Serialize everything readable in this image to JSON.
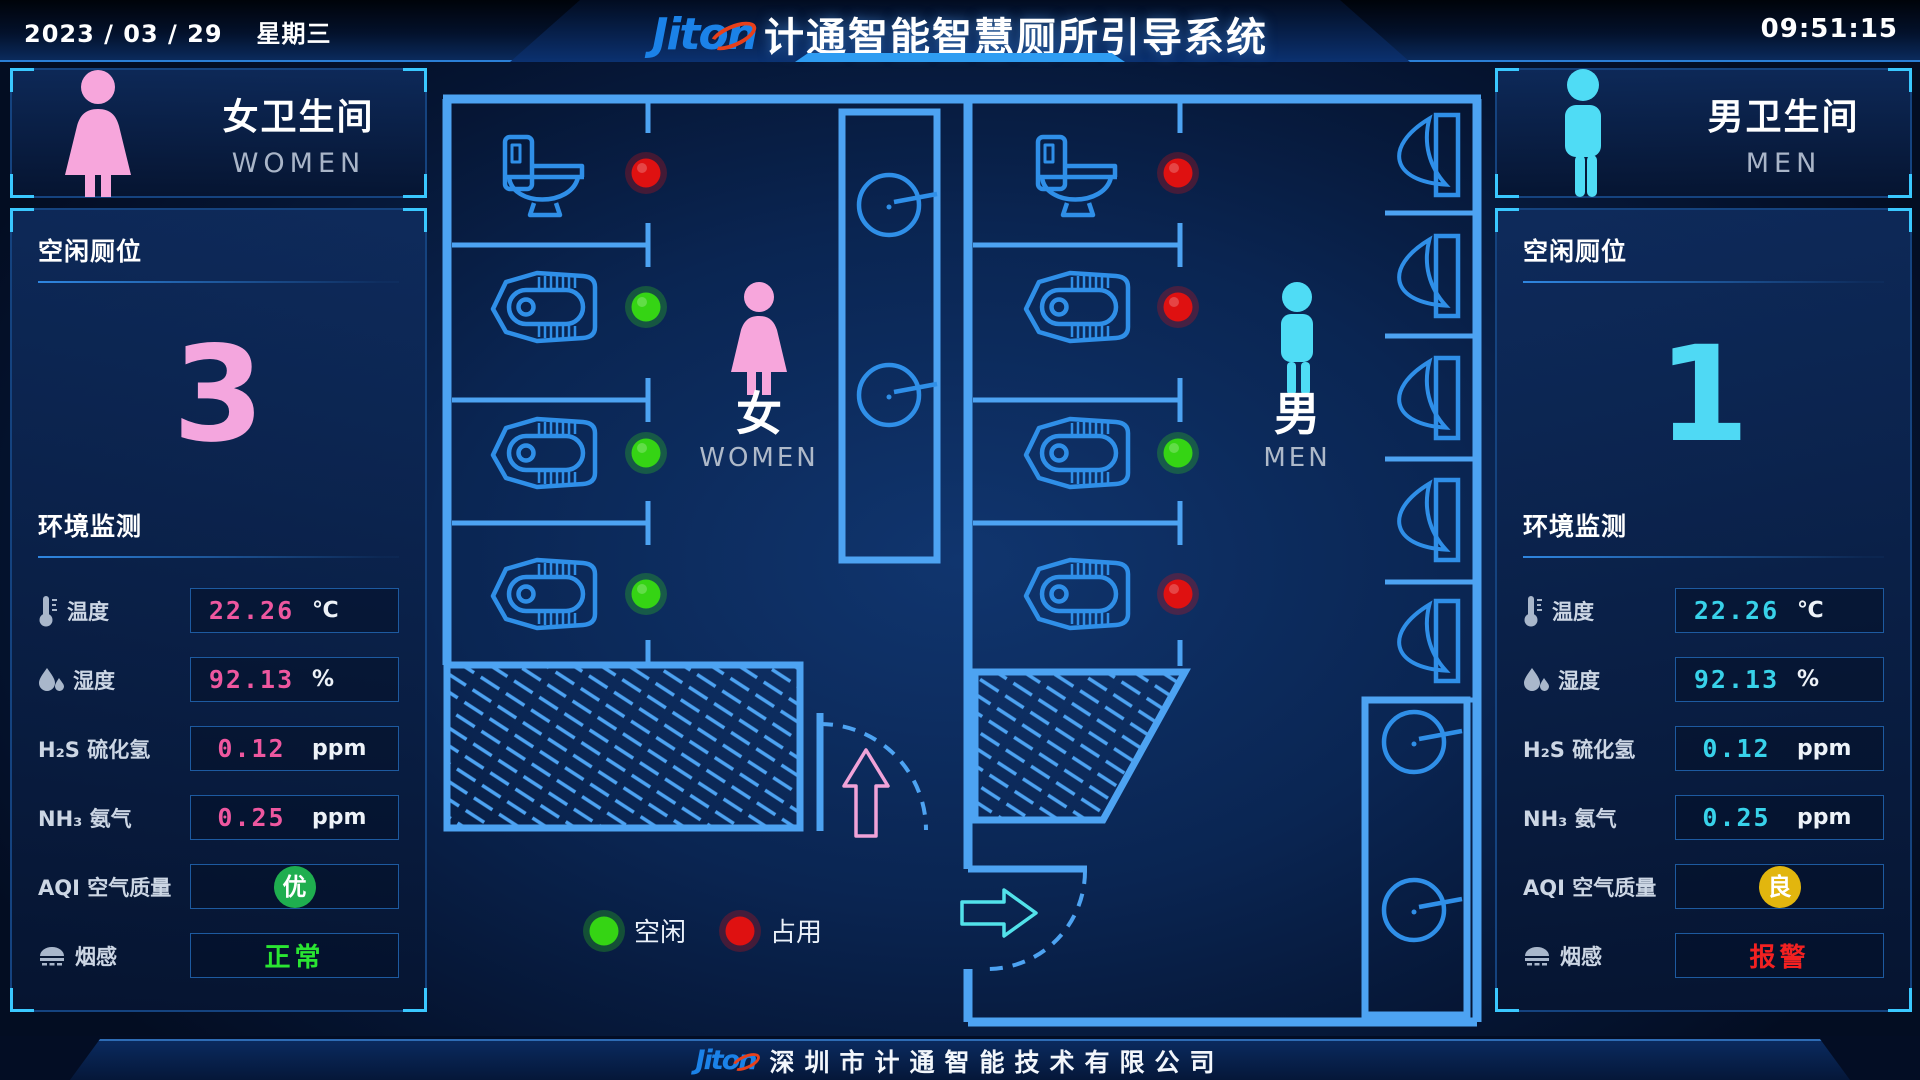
{
  "header": {
    "date": "2023 / 03 / 29",
    "weekday": "星期三",
    "logo": "Jiton",
    "title": "计通智能智慧厕所引导系统",
    "time": "09:51:15"
  },
  "footer": {
    "logo": "Jiton",
    "company": "深圳市计通智能技术有限公司"
  },
  "women_panel": {
    "name": "女卫生间",
    "name_en": "WOMEN",
    "accent": "#f4a6de",
    "vacant_label": "空闲厕位",
    "vacant_count": "3",
    "env_label": "环境监测",
    "metrics": {
      "temp": {
        "label": "温度",
        "value": "22.26",
        "unit": "℃"
      },
      "humidity": {
        "label": "湿度",
        "value": "92.13",
        "unit": "%"
      },
      "h2s": {
        "label": "H₂S 硫化氢",
        "value": "0.12",
        "unit": "ppm"
      },
      "nh3": {
        "label": "NH₃ 氨气",
        "value": "0.25",
        "unit": "ppm"
      },
      "aqi": {
        "label": "AQI 空气质量",
        "value": "优",
        "color": "#1fae4f"
      },
      "smoke": {
        "label": "烟感",
        "value": "正常",
        "color": "#2ae532"
      }
    }
  },
  "men_panel": {
    "name": "男卫生间",
    "name_en": "MEN",
    "accent": "#4fd9f4",
    "vacant_label": "空闲厕位",
    "vacant_count": "1",
    "env_label": "环境监测",
    "metrics": {
      "temp": {
        "label": "温度",
        "value": "22.26",
        "unit": "℃"
      },
      "humidity": {
        "label": "湿度",
        "value": "92.13",
        "unit": "%"
      },
      "h2s": {
        "label": "H₂S 硫化氢",
        "value": "0.12",
        "unit": "ppm"
      },
      "nh3": {
        "label": "NH₃ 氨气",
        "value": "0.25",
        "unit": "ppm"
      },
      "aqi": {
        "label": "AQI 空气质量",
        "value": "良",
        "color": "#e2b60e"
      },
      "smoke": {
        "label": "烟感",
        "value": "报警",
        "color": "#f32121"
      }
    }
  },
  "floorplan": {
    "women_label": "女",
    "women_label_en": "WOMEN",
    "men_label": "男",
    "men_label_en": "MEN",
    "legend": {
      "vacant": "空闲",
      "occupied": "占用"
    },
    "colors": {
      "vacant": "#35d414",
      "occupied": "#df1111"
    },
    "women_stalls": [
      "occupied",
      "vacant",
      "vacant",
      "vacant"
    ],
    "men_stalls": [
      "occupied",
      "occupied",
      "vacant",
      "occupied"
    ],
    "urinal_count": 5
  },
  "icons": {
    "woman": "woman-figure-icon",
    "man": "man-figure-icon",
    "thermometer": "thermometer-icon",
    "humidity": "water-drops-icon",
    "smoke": "smoke-detector-icon",
    "toilet": "sitting-toilet-icon",
    "squat": "squat-toilet-icon",
    "urinal": "urinal-icon",
    "sink": "sink-icon",
    "entry_women": "pink-up-arrow-icon",
    "entry_men": "cyan-right-arrow-icon"
  }
}
